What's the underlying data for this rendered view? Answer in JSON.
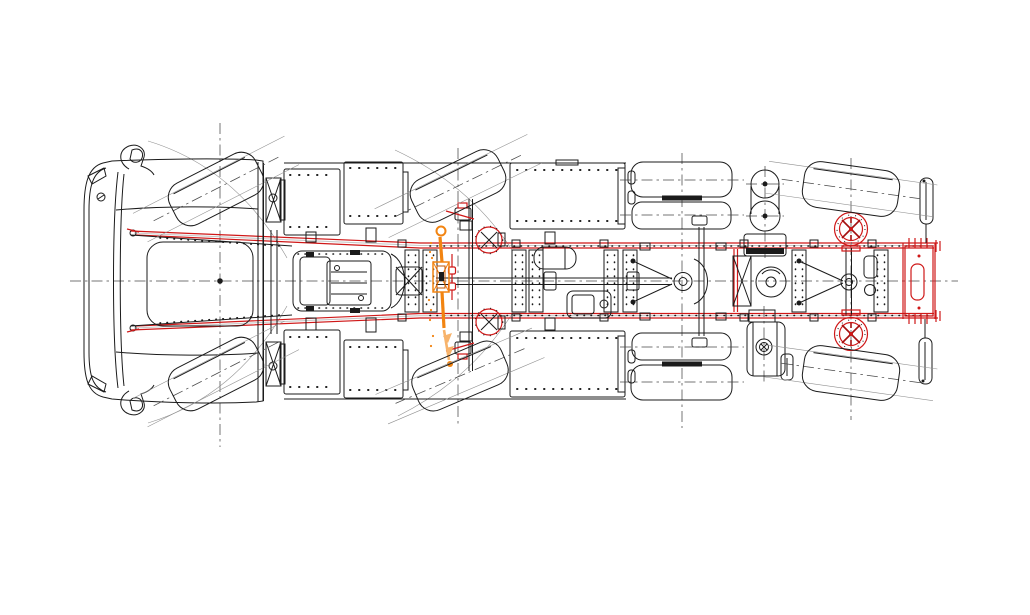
{
  "drawing": {
    "title": "Truck chassis engineering drawing - top (plan) view",
    "view": "top",
    "axle_count": 4,
    "colors": {
      "background": "#ffffff",
      "line": "#1b1b1b",
      "thin_line": "#909090",
      "centerline": "#4a4a4a",
      "accent_red": "#cf1818",
      "accent_dark_red": "#a31111",
      "accent_orange": "#f28411",
      "accent_orange_dark": "#c25400",
      "accent_orange_light": "#f7b36b"
    },
    "highlighted": {
      "red_parts": [
        "frame-rails",
        "rear-crossmember",
        "axle4-brake-drums",
        "axle2-hub-faces",
        "steering-tie-link",
        "spring-shackles"
      ],
      "orange_parts": [
        "steering-linkage",
        "drag-link",
        "steering-gear-bracket"
      ]
    },
    "components": [
      "cab",
      "left-mirror",
      "right-mirror",
      "front-bumper",
      "windshield",
      "roof-panel",
      "brand-logo-mark",
      "cab-rear-wall",
      "battery-box",
      "tool-box",
      "engine-block",
      "transmission",
      "driveshaft",
      "frame-rail-left",
      "frame-rail-right",
      "crossmember-gussets",
      "rear-crossmember",
      "leaf-spring-front-left",
      "leaf-spring-front-right",
      "tire-axle1-left",
      "tire-axle1-right",
      "tire-axle2-left",
      "tire-axle2-right",
      "dual-tires-axle3-left",
      "dual-tires-axle3-right",
      "tire-axle4-left",
      "tire-axle4-right",
      "axle2-beam",
      "axle3-differential",
      "axle3-torque-rods",
      "axle4-differential",
      "axle4-torque-rods",
      "air-tanks",
      "air-bellows",
      "fuel-tank",
      "filler-cap",
      "mud-flap-left",
      "mud-flap-right",
      "brake-drum-axle4-left",
      "brake-drum-axle4-right",
      "vehicle-centerline",
      "axle1-centerline",
      "axle2-centerline",
      "axle3-centerline",
      "axle4-centerline"
    ]
  }
}
